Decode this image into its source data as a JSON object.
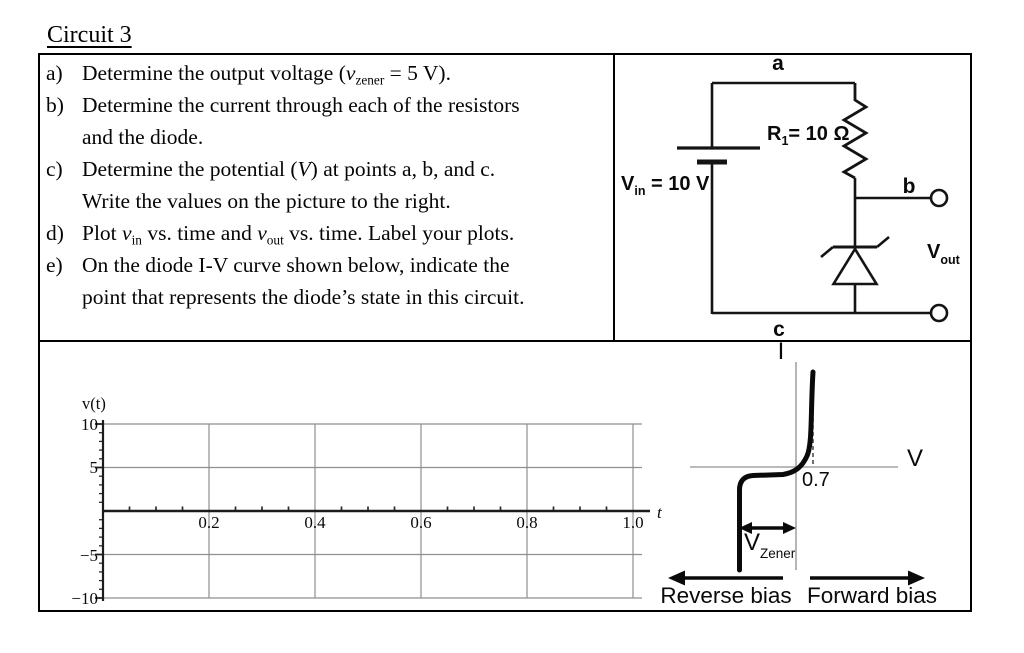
{
  "title": "Circuit 3",
  "questions": [
    {
      "label": "a)",
      "segments": [
        {
          "s": "p",
          "t": "Determine the output voltage ("
        },
        {
          "s": "i",
          "t": "v"
        },
        {
          "s": "sub",
          "t": "zener"
        },
        {
          "s": "p",
          "t": " = 5 V)."
        }
      ]
    },
    {
      "label": "b)",
      "segments": [
        {
          "s": "p",
          "t": "Determine the current through each of the resistors"
        },
        {
          "s": "br"
        },
        {
          "s": "p",
          "t": "and the diode."
        }
      ]
    },
    {
      "label": "c)",
      "segments": [
        {
          "s": "p",
          "t": "Determine the potential ("
        },
        {
          "s": "i",
          "t": "V"
        },
        {
          "s": "p",
          "t": ") at points a, b, and c."
        },
        {
          "s": "br"
        },
        {
          "s": "p",
          "t": "Write the values on the picture to the right."
        }
      ]
    },
    {
      "label": "d)",
      "segments": [
        {
          "s": "p",
          "t": "Plot "
        },
        {
          "s": "i",
          "t": "v"
        },
        {
          "s": "sub",
          "t": "in"
        },
        {
          "s": "p",
          "t": " vs. time and "
        },
        {
          "s": "i",
          "t": "v"
        },
        {
          "s": "sub",
          "t": "out"
        },
        {
          "s": "p",
          "t": " vs. time. Label your plots."
        }
      ]
    },
    {
      "label": "e)",
      "segments": [
        {
          "s": "p",
          "t": "On the diode I-V curve shown below, indicate the"
        },
        {
          "s": "br"
        },
        {
          "s": "p",
          "t": "point that represents the diode’s state in this circuit."
        }
      ]
    }
  ],
  "circuit": {
    "node_a": "a",
    "node_b": "b",
    "node_c": "c",
    "source": {
      "main": "V",
      "sub": "in",
      "rest": " = 10 V"
    },
    "resistor": {
      "main": "R",
      "sub": "1",
      "rest": "= 10 Ω"
    },
    "vout": {
      "main": "V",
      "sub": "out"
    }
  },
  "graph": {
    "ylabel": "v(t)",
    "xlabel": "t",
    "yticks": [
      "10",
      "5",
      "−5",
      "−10"
    ],
    "xticks": [
      "0.2",
      "0.4",
      "0.6",
      "0.8",
      "1.0"
    ]
  },
  "diode_figure": {
    "iaxis": "I",
    "vaxis": "V",
    "knee": "0.7",
    "vzener": {
      "main": "V",
      "sub": "Zener"
    },
    "reverse": "Reverse bias",
    "forward": "Forward bias"
  },
  "chart_data": [
    {
      "type": "line",
      "title": "Blank plotting grid for v_in and v_out vs. time",
      "xlabel": "t",
      "ylabel": "v(t)",
      "xlim": [
        0,
        1.05
      ],
      "ylim": [
        -10,
        10
      ],
      "xticks": [
        0.2,
        0.4,
        0.6,
        0.8,
        1.0
      ],
      "yticks": [
        -10,
        -5,
        5,
        10
      ],
      "grid": true,
      "legend": false,
      "series": []
    },
    {
      "type": "line",
      "title": "Diode I-V characteristic (qualitative)",
      "xlabel": "V",
      "ylabel": "I",
      "grid": false,
      "annotations": [
        "0.7",
        "V_Zener",
        "Reverse bias",
        "Forward bias"
      ],
      "features": {
        "forward_knee_V": 0.7,
        "reverse_breakdown_V": "-V_Zener"
      },
      "series": [
        {
          "name": "diode-iv",
          "x": [
            -1.0,
            -1.0,
            -0.97,
            -0.6,
            -0.2,
            0.0,
            0.4,
            0.62,
            0.7,
            0.73
          ],
          "y": [
            -3.5,
            -0.5,
            -0.15,
            -0.1,
            -0.08,
            0.0,
            0.05,
            0.4,
            1.8,
            3.6
          ]
        }
      ]
    }
  ]
}
